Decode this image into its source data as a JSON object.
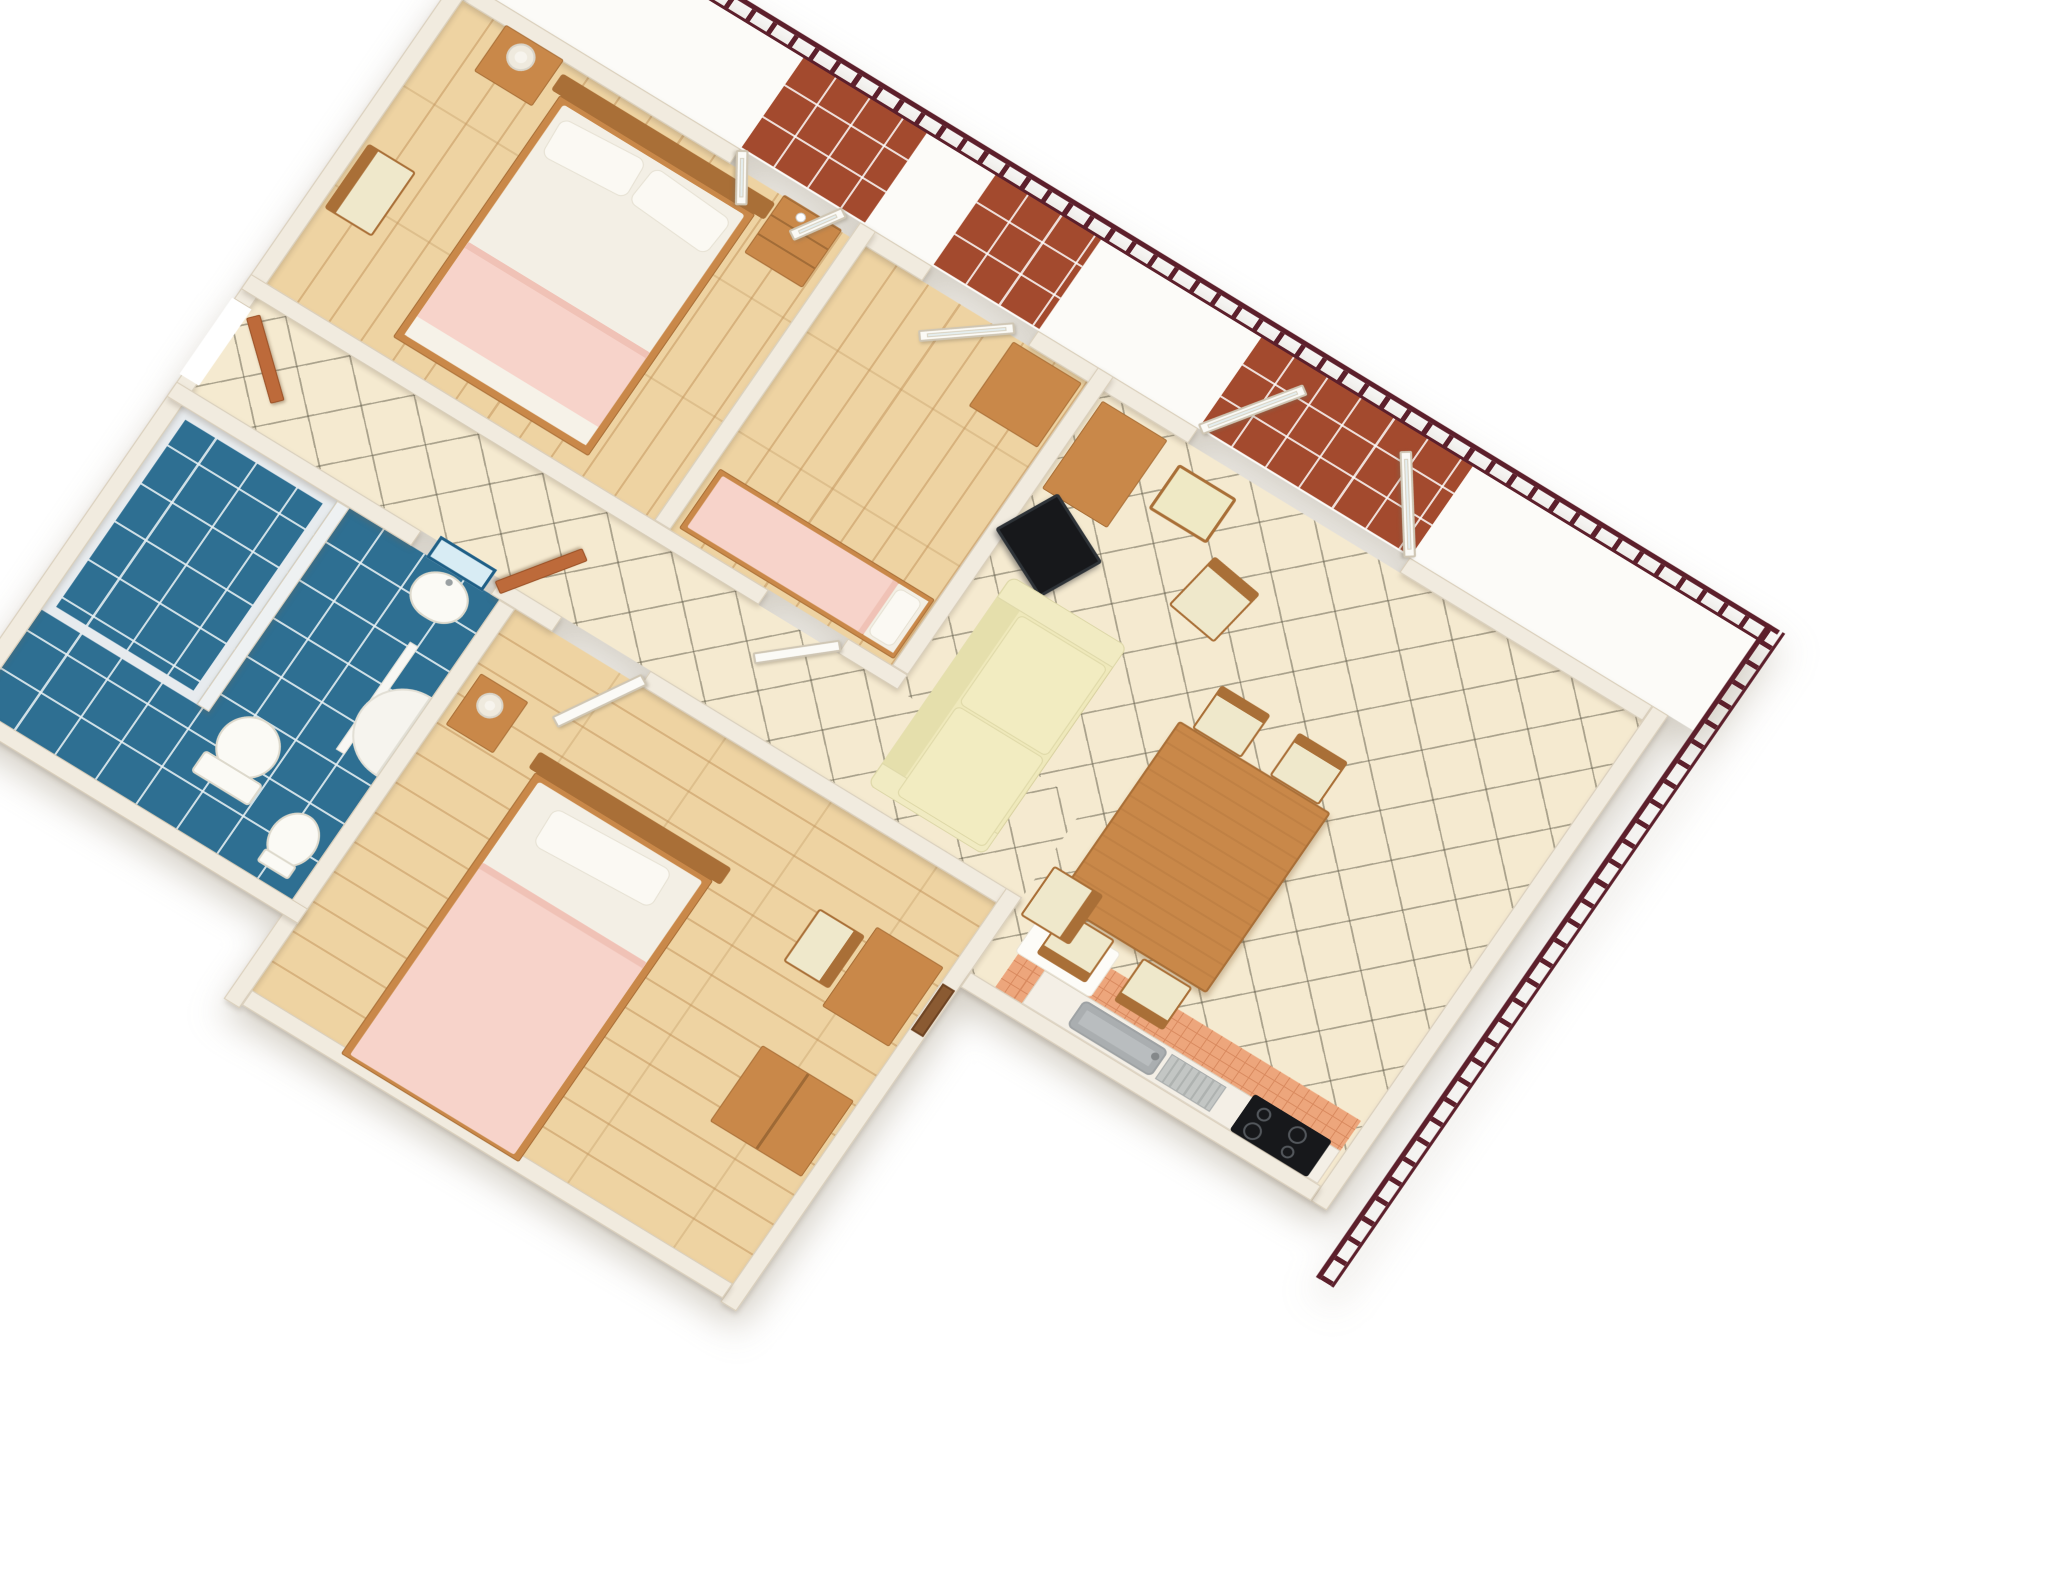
{
  "meta": {
    "title": "3D isometric floor plan render of a two-bedroom-plus-one apartment with balcony",
    "view": "bird's-eye dollhouse render, walls cut at top, white background",
    "background": "#ffffff"
  },
  "palette": {
    "wall": "#f1ebdf",
    "wallEdge": "#d8cdb9",
    "wood": "#eed3a2",
    "woodLine": "rgba(196,150,94,0.55)",
    "tile": "#f5ead0",
    "tileLine": "rgba(95,90,72,0.50)",
    "bath": "#2e6f92",
    "bathLine": "rgba(235,243,245,0.85)",
    "balconyTile": "#a34a2e",
    "railing": "#5c1f2b",
    "doorWood": "#bd6a3a",
    "white": "#fbfaf6",
    "sofa": "#efe9bb",
    "woodFurn": "#c98849",
    "woodFurnDark": "#a96f37",
    "pink": "#f7d3ca",
    "sheet": "#f3efe5",
    "terracotta": "#eda67c",
    "tv": "#17181b",
    "counter": "#f4efe6",
    "sink": "#b9bdbf",
    "blue": "#1f5f86"
  },
  "rooms": [
    {
      "id": "bedroom-1",
      "name": "Bedroom 1",
      "floor": "light wood parquet",
      "furniture": [
        "double bed with white sheets and pink blanket",
        "two pillows",
        "wooden headboard",
        "nightstand with drawers",
        "bedside table with lamp",
        "wooden chair"
      ]
    },
    {
      "id": "bedroom-2",
      "name": "Bedroom 2",
      "floor": "light wood parquet",
      "furniture": [
        "single bed with pink blanket",
        "desk"
      ],
      "openings": [
        "glazed door to balcony"
      ]
    },
    {
      "id": "living-dining-room",
      "name": "Living / dining room",
      "floor": "cream ceramic tiles laid diagonally",
      "furniture": [
        "cream three-seat sofa",
        "corner TV on stand",
        "side desk",
        "bench stool",
        "occasional chairs",
        "wooden dining table",
        "four dining chairs"
      ],
      "openings": [
        "double french doors to balcony"
      ]
    },
    {
      "id": "kitchen",
      "name": "Kitchen corner",
      "floor": "terracotta tiles",
      "fixtures": [
        "white counter",
        "grey sink with drainboard",
        "black 4-burner cooktop",
        "white floor mat"
      ]
    },
    {
      "id": "hallway",
      "name": "Hallway",
      "floor": "cream ceramic tiles",
      "openings": [
        "entry door",
        "bathroom door",
        "bedroom 2 door",
        "bedroom 3 door"
      ]
    },
    {
      "id": "bathroom",
      "name": "Bathroom",
      "floor": "blue ceramic tiles laid diagonally",
      "fixtures": [
        "tiled shower room",
        "washbasin",
        "blue-framed mirror",
        "toilet",
        "bidet",
        "corner tub",
        "white partition screen"
      ]
    },
    {
      "id": "bedroom-3",
      "name": "Bedroom 3",
      "floor": "light wood parquet",
      "furniture": [
        "bed with white sheets and pink blanket",
        "nightstand with lamp",
        "desk",
        "chair",
        "wardrobe",
        "picture frame on wall"
      ]
    },
    {
      "id": "balcony",
      "name": "Balcony",
      "floor": "red quarry tiles at doorways",
      "fixtures": [
        "dark maroon metal railing"
      ]
    }
  ],
  "doors": [
    {
      "id": "entry-door",
      "material": "wood",
      "state": "open into hallway"
    },
    {
      "id": "bathroom-door",
      "material": "wood",
      "state": "open into hallway"
    },
    {
      "id": "bedroom-2-door",
      "material": "white",
      "state": "ajar"
    },
    {
      "id": "bedroom-3-door",
      "material": "white",
      "state": "open into bedroom"
    },
    {
      "id": "bedroom-1-balcony-doors",
      "material": "white french pair",
      "state": "open into room"
    },
    {
      "id": "bedroom-2-balcony-door",
      "material": "white glazed",
      "state": "open into room"
    },
    {
      "id": "living-balcony-doors",
      "material": "white french pair",
      "state": "open onto balcony"
    }
  ]
}
